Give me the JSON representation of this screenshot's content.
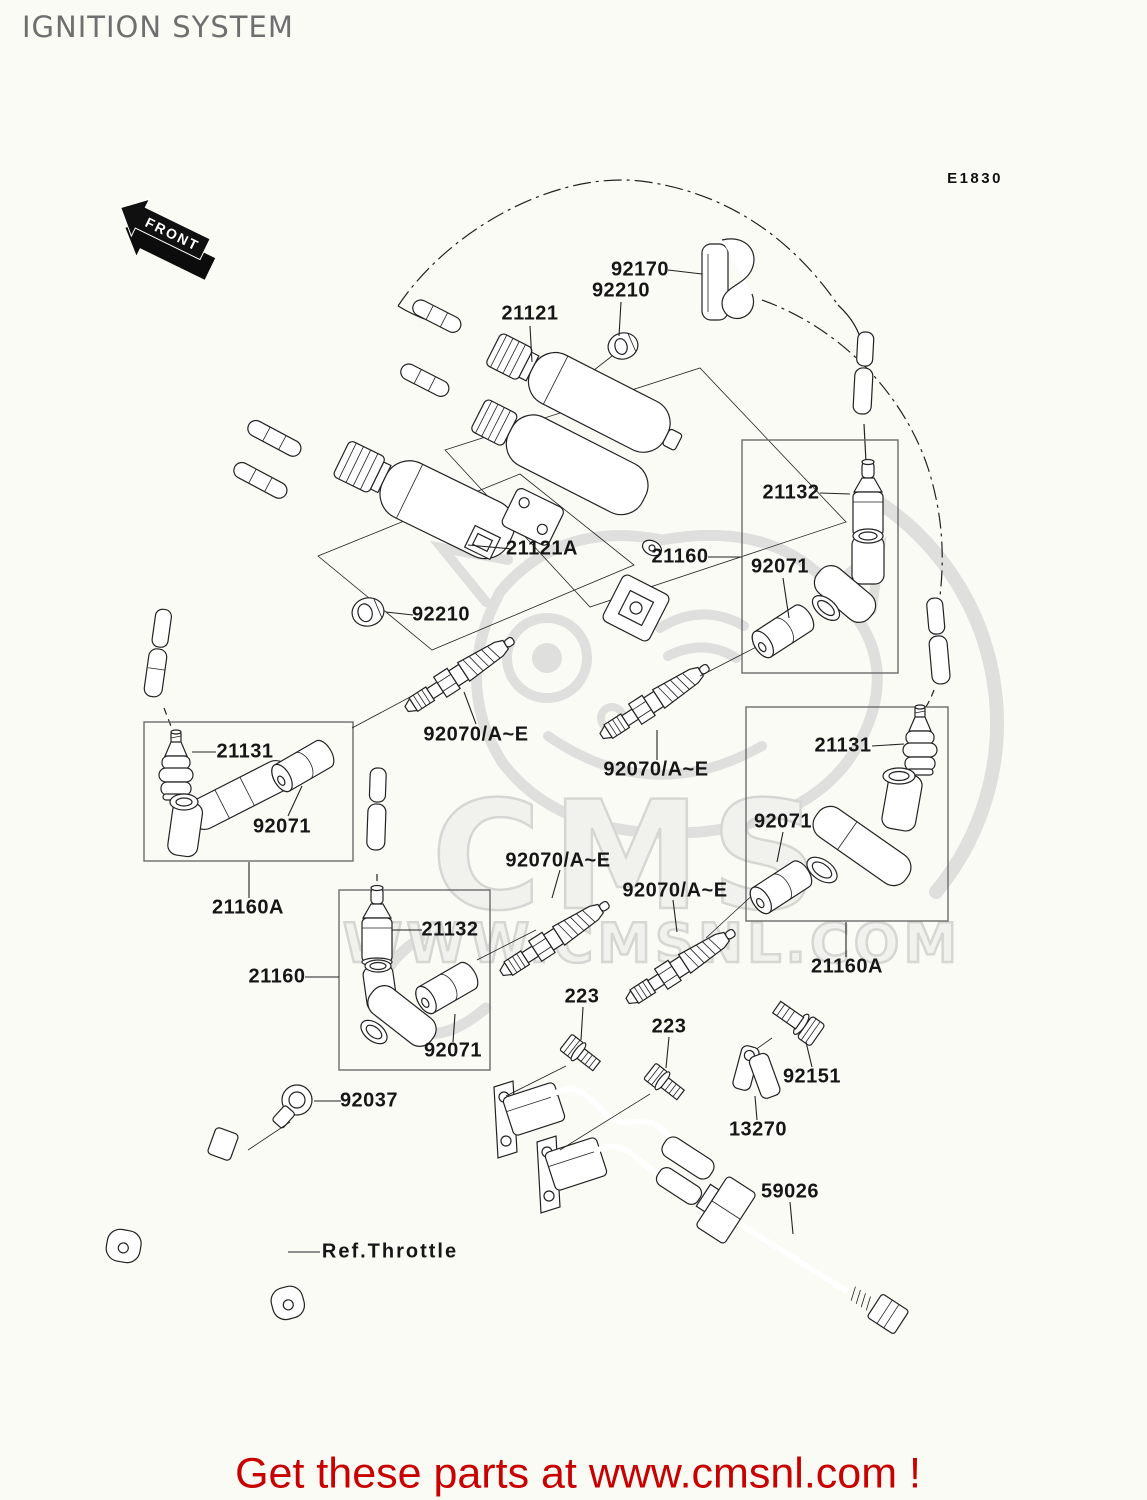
{
  "page": {
    "title": "IGNITION SYSTEM",
    "diagram_code": "E1830",
    "front_marker": "FRONT",
    "footer": "Get these parts at www.cmsnl.com !",
    "watermark_big": "CMS",
    "watermark_url": "WWW.CMSNL.COM"
  },
  "colors": {
    "footer_red": "#c80000",
    "title_gray": "#6f6f6f",
    "line_black": "#222222",
    "watermark_gray": "#dcdcdc"
  },
  "labels": [
    {
      "id": "92170",
      "text": "92170"
    },
    {
      "id": "92210-top",
      "text": "92210"
    },
    {
      "id": "21121",
      "text": "21121"
    },
    {
      "id": "21132-right",
      "text": "21132"
    },
    {
      "id": "21160-right",
      "text": "21160"
    },
    {
      "id": "92071-right-top",
      "text": "92071"
    },
    {
      "id": "21121a",
      "text": "21121A"
    },
    {
      "id": "92210-left",
      "text": "92210"
    },
    {
      "id": "21131-left",
      "text": "21131"
    },
    {
      "id": "92070-1",
      "text": "92070/A~E"
    },
    {
      "id": "92070-2",
      "text": "92070/A~E"
    },
    {
      "id": "21131-right",
      "text": "21131"
    },
    {
      "id": "92071-left",
      "text": "92071"
    },
    {
      "id": "92071-right-mid",
      "text": "92071"
    },
    {
      "id": "21160a-left",
      "text": "21160A"
    },
    {
      "id": "92070-3",
      "text": "92070/A~E"
    },
    {
      "id": "92070-4",
      "text": "92070/A~E"
    },
    {
      "id": "21132-mid",
      "text": "21132"
    },
    {
      "id": "21160-mid",
      "text": "21160"
    },
    {
      "id": "21160a-right",
      "text": "21160A"
    },
    {
      "id": "92071-mid",
      "text": "92071"
    },
    {
      "id": "223-1",
      "text": "223"
    },
    {
      "id": "223-2",
      "text": "223"
    },
    {
      "id": "92151",
      "text": "92151"
    },
    {
      "id": "13270",
      "text": "13270"
    },
    {
      "id": "59026",
      "text": "59026"
    },
    {
      "id": "92037",
      "text": "92037"
    },
    {
      "id": "ref-throttle",
      "text": "Ref.Throttle"
    }
  ]
}
